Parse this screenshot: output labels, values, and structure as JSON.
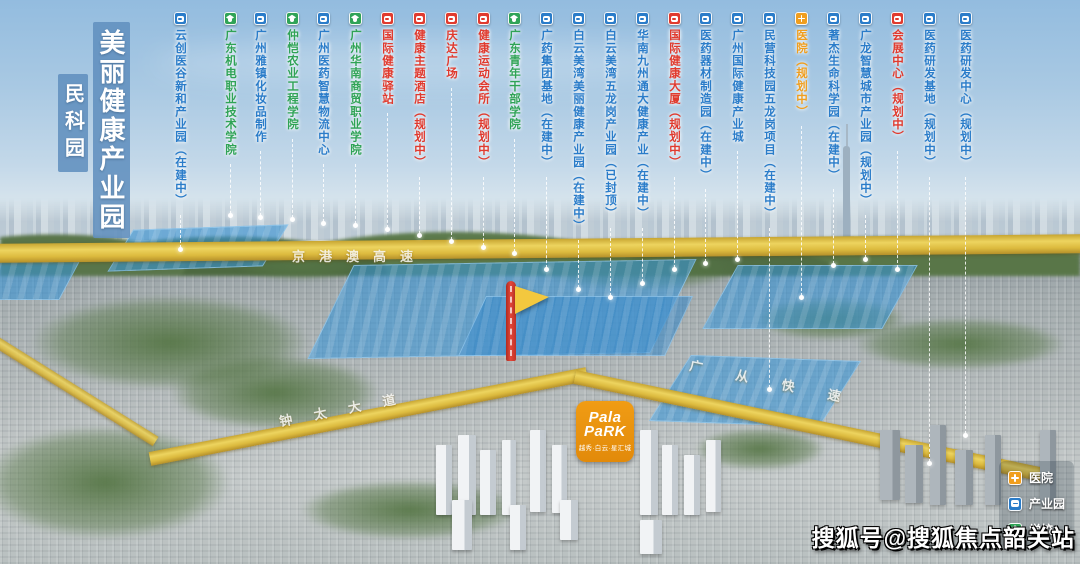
{
  "title": {
    "main": "美丽健康产业园",
    "sub": "民科园"
  },
  "marker_types": {
    "industry": {
      "color": "#2a7cc9",
      "icon": "building-icon",
      "label": "产业园"
    },
    "school": {
      "color": "#2fa356",
      "icon": "school-icon",
      "label": "学校"
    },
    "facility": {
      "color": "#e03a2e",
      "icon": "building-icon",
      "label": "配套"
    },
    "hospital": {
      "color": "#f09e1e",
      "icon": "cross-icon",
      "label": "医院"
    }
  },
  "map_labels": [
    {
      "text": "云创医谷新和产业园（在建中）",
      "type": "industry",
      "x": 180,
      "line_end_y": 252
    },
    {
      "text": "广东机电职业技术学院",
      "type": "school",
      "x": 230,
      "line_end_y": 218
    },
    {
      "text": "广州雅镇化妆品制作",
      "type": "industry",
      "x": 260,
      "line_end_y": 220
    },
    {
      "text": "仲恺农业工程学院",
      "type": "school",
      "x": 292,
      "line_end_y": 222
    },
    {
      "text": "广州医药智慧物流中心",
      "type": "industry",
      "x": 323,
      "line_end_y": 226
    },
    {
      "text": "广州华南商贸职业学院",
      "type": "school",
      "x": 355,
      "line_end_y": 228
    },
    {
      "text": "国际健康驿站",
      "type": "facility",
      "x": 387,
      "line_end_y": 232
    },
    {
      "text": "健康主题酒店（规划中）",
      "type": "facility",
      "x": 419,
      "line_end_y": 238
    },
    {
      "text": "庆达广场",
      "type": "facility",
      "x": 451,
      "line_end_y": 244
    },
    {
      "text": "健康运动会所（规划中）",
      "type": "facility",
      "x": 483,
      "line_end_y": 250
    },
    {
      "text": "广东青年干部学院",
      "type": "school",
      "x": 514,
      "line_end_y": 256
    },
    {
      "text": "广药集团基地（在建中）",
      "type": "industry",
      "x": 546,
      "line_end_y": 272
    },
    {
      "text": "白云美湾美丽健康产业园（在建中）",
      "type": "industry",
      "x": 578,
      "line_end_y": 292
    },
    {
      "text": "白云美湾五龙岗产业园（已封顶）",
      "type": "industry",
      "x": 610,
      "line_end_y": 300
    },
    {
      "text": "华南九州通大健康产业（在建中）",
      "type": "industry",
      "x": 642,
      "line_end_y": 286
    },
    {
      "text": "国际健康大厦（规划中）",
      "type": "facility",
      "x": 674,
      "line_end_y": 272
    },
    {
      "text": "医药器材制造园（在建中）",
      "type": "industry",
      "x": 705,
      "line_end_y": 266
    },
    {
      "text": "广州国际健康产业城",
      "type": "industry",
      "x": 737,
      "line_end_y": 262
    },
    {
      "text": "民营科技园五龙岗项目（在建中）",
      "type": "industry",
      "x": 769,
      "line_end_y": 392
    },
    {
      "text": "医院（规划中）",
      "type": "hospital",
      "x": 801,
      "line_end_y": 300
    },
    {
      "text": "著杰生命科学园（在建中）",
      "type": "industry",
      "x": 833,
      "line_end_y": 268
    },
    {
      "text": "广龙智慧城市产业园（规划中）",
      "type": "industry",
      "x": 865,
      "line_end_y": 262
    },
    {
      "text": "会展中心（规划中）",
      "type": "facility",
      "x": 897,
      "line_end_y": 272
    },
    {
      "text": "医药研发基地（规划中）",
      "type": "industry",
      "x": 929,
      "line_end_y": 466
    },
    {
      "text": "医药研发中心（规划中）",
      "type": "industry",
      "x": 965,
      "line_end_y": 438
    }
  ],
  "roads": [
    {
      "name": "京港澳高速"
    },
    {
      "name": "钟太大道"
    },
    {
      "name": "广从快速"
    }
  ],
  "project_marker": {
    "logo_line1": "Pala",
    "logo_line2": "PaRK",
    "subtitle": "越秀·白云·星汇城"
  },
  "legend": [
    {
      "label": "医院",
      "type": "hospital"
    },
    {
      "label": "产业园",
      "type": "industry"
    },
    {
      "label": "学校",
      "type": "school"
    }
  ],
  "watermark": "搜狐号@搜狐焦点韶关站"
}
